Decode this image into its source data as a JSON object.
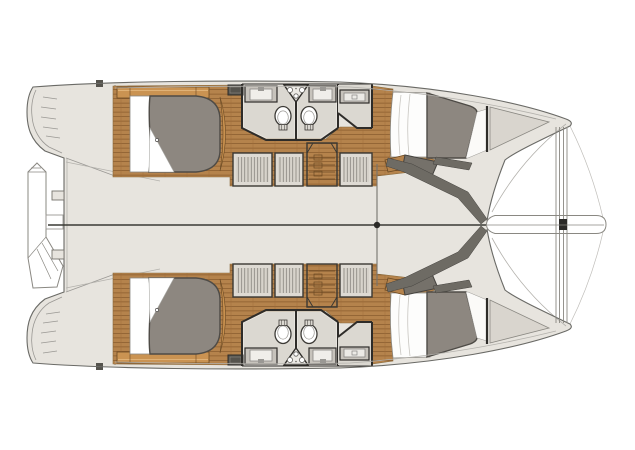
{
  "figure": {
    "type": "boat-floor-plan",
    "subject": "Sailing catamaran accommodation and deck plan, plan (top) view",
    "orientation": "bow to the right, stern to the left",
    "symmetry": "port and starboard hulls mirrored about the horizontal centerline"
  },
  "colors": {
    "background": "#ffffff",
    "deck": "#e7e4de",
    "outline": "#6a6a66",
    "wall": "#2e2c29",
    "wood": "#b5834c",
    "wood_dark": "#8a5c2e",
    "wood_trim": "#ca9352",
    "wood_trim_edge": "#6b4a24",
    "duvet": "#8d8780",
    "duvet_edge": "#4e4b46",
    "room_floor": "#dbd8d1",
    "counter": "#c7c3bc",
    "counter_inner": "#f0eeea",
    "fixture_white": "#ffffff",
    "step_band": "#6e6b64",
    "locker_panel": "#d9d5ce",
    "hatch": "#55534d",
    "accent_black": "#2b2a27",
    "thin_line": "#9a9894",
    "faint_line": "#b3b1ac",
    "wardrobe_bg": "#dedad3"
  },
  "features": {
    "per_hull": [
      {
        "name": "transom-steps",
        "position": "stern"
      },
      {
        "name": "aft-cabin",
        "items": [
          "island-double-berth",
          "hull-shelf",
          "deck-hatch"
        ]
      },
      {
        "name": "head-compartments",
        "count": 2,
        "items": [
          "sink-vanity",
          "toilet",
          "corner-shower-unit"
        ]
      },
      {
        "name": "vanity-room",
        "items": [
          "sink-vanity"
        ]
      },
      {
        "name": "wardrobe-lockers",
        "count": 3
      },
      {
        "name": "companionway-stairs"
      },
      {
        "name": "forward-cabin",
        "items": [
          "double-berth"
        ]
      },
      {
        "name": "anchor-locker",
        "position": "bow"
      }
    ],
    "centerline_items": [
      "stern-platform",
      "tender-outline",
      "mast-step",
      "forward-crossbeam",
      "bowsprit"
    ]
  }
}
